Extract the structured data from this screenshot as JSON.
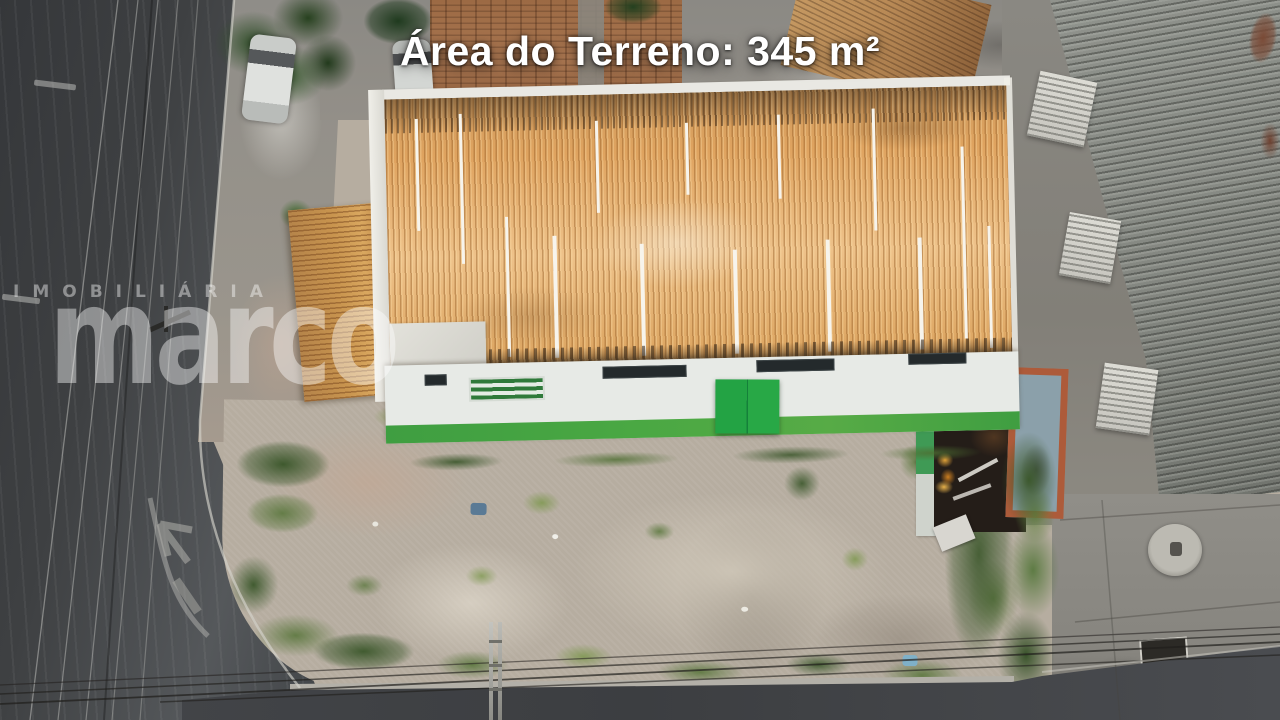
{
  "overlay": {
    "area_label": "Área do Terreno: 345 m²"
  },
  "watermark": {
    "logo_text": "marco",
    "subtitle": "IMOBILIÁRIA"
  },
  "colors": {
    "asphalt": "#3e4042",
    "asphalt_light": "#55585b",
    "sidewalk": "#8f8d88",
    "dirt": "#b6ada0",
    "roof_orange": "#dfa35f",
    "roof_orange_light": "#eec28a",
    "annex_tan": "#c8944e",
    "wall_white": "#e7eae6",
    "parapet_white": "#e9e8e3",
    "stripe_green": "#4aa843",
    "door_green": "#23a344",
    "gray_roof": "#90938d",
    "gray_roof_dark": "#6f726c",
    "pool_blue": "#8ba0aa",
    "pool_brick": "#ad5b3a",
    "headline_text": "#ffffff",
    "watermark_alpha": "0.42"
  }
}
